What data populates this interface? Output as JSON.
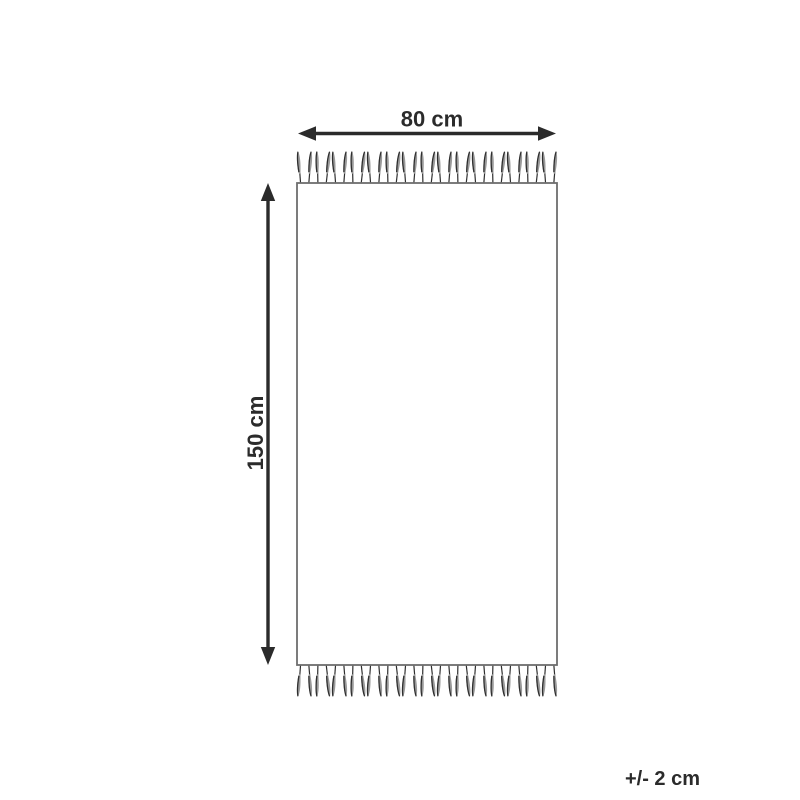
{
  "labels": {
    "width": "80 cm",
    "height": "150 cm",
    "tolerance": "+/- 2 cm"
  },
  "colors": {
    "ink": "#2b2b2b",
    "rug_outline": "#6e6e6e",
    "tassel_dark": "#2f2f2f",
    "tassel_light": "#9a9a9a",
    "background": "#ffffff"
  }
}
